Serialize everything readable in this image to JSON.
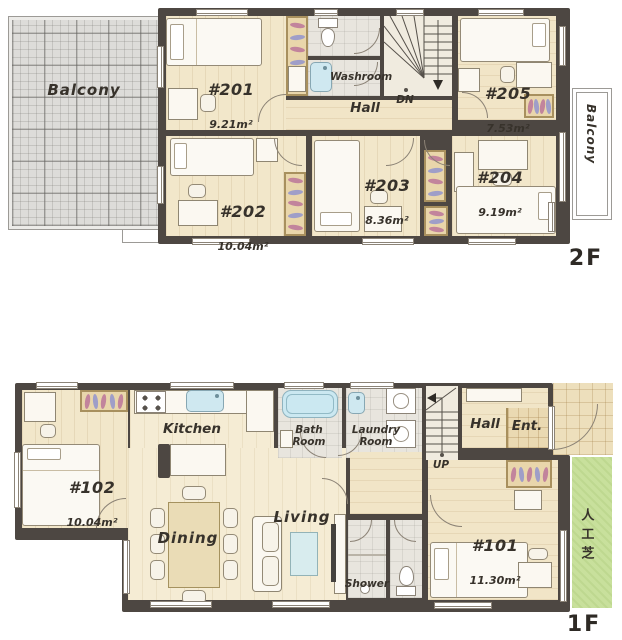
{
  "palette": {
    "wall": "#4d4742",
    "wood_floor": "#f2e7ca",
    "wet_floor": "#e8e5de",
    "closet": "#e9d6ab",
    "balcony_tile": "#dddcd9",
    "turf_green": "#c8e09c",
    "water_blue": "#cbe8f1",
    "hanger_pink": "#c2849c",
    "hanger_purple": "#9f9ec8",
    "ink": "#37322b"
  },
  "floor2": {
    "floor_label": "2F",
    "balcony_left": "Balcony",
    "balcony_right": "Balcony",
    "washroom": "Washroom",
    "hall": "Hall",
    "stairs": "DN",
    "rooms": {
      "r201": {
        "name": "#201",
        "area": "9.21m²"
      },
      "r202": {
        "name": "#202",
        "area": "10.04m²"
      },
      "r203": {
        "name": "#203",
        "area": "8.36m²"
      },
      "r204": {
        "name": "#204",
        "area": "9.19m²"
      },
      "r205": {
        "name": "#205",
        "area": "7.53m²"
      }
    }
  },
  "floor1": {
    "floor_label": "1F",
    "kitchen": "Kitchen",
    "bath": "Bath\nRoom",
    "laundry": "Laundry\nRoom",
    "hall": "Hall",
    "entrance": "Ent.",
    "stairs": "UP",
    "dining": "Dining",
    "living": "Living",
    "shower": "Shower",
    "turf": "人工芝",
    "rooms": {
      "r101": {
        "name": "#101",
        "area": "11.30m²"
      },
      "r102": {
        "name": "#102",
        "area": "10.04m²"
      }
    }
  }
}
